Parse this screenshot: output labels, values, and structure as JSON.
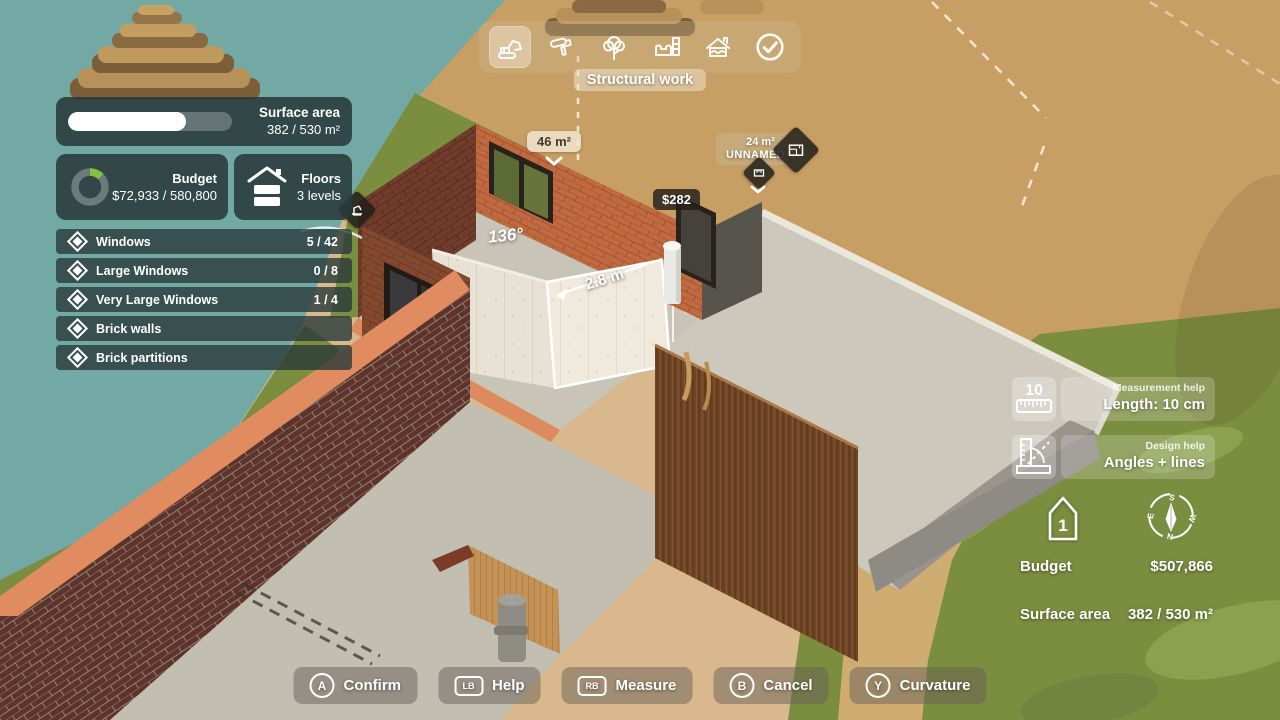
{
  "toolbar": {
    "tools": [
      {
        "icon": "excavator-icon",
        "selected": true
      },
      {
        "icon": "paint-roller-icon",
        "selected": false
      },
      {
        "icon": "tree-icon",
        "selected": false
      },
      {
        "icon": "furniture-icon",
        "selected": false
      },
      {
        "icon": "roof-icon",
        "selected": false
      },
      {
        "icon": "check-circle-icon",
        "selected": false
      }
    ],
    "active_tool_label": "Structural work"
  },
  "surface_panel": {
    "title": "Surface area",
    "value": "382 / 530 m²",
    "progress_pct": 72.1,
    "fill_style": "width:72.1%"
  },
  "budget_panel": {
    "title": "Budget",
    "value": "$72,933 / 580,800",
    "progress_pct": 12.6,
    "donut_dash": "11.9 82.4",
    "donut_color": "#84c341"
  },
  "floors_panel": {
    "title": "Floors",
    "value": "3 levels"
  },
  "materials": [
    {
      "label": "Windows",
      "count": "5 / 42"
    },
    {
      "label": "Large Windows",
      "count": "0 / 8"
    },
    {
      "label": "Very Large Windows",
      "count": "1 / 4"
    },
    {
      "label": "Brick walls",
      "count": ""
    },
    {
      "label": "Brick partitions",
      "count": ""
    }
  ],
  "scene": {
    "area_label": "46 m²",
    "cost_label": "$282",
    "room_area": "24 m²",
    "room_name": "UNNAMED 4",
    "angle": "136°",
    "length": "2.8 m"
  },
  "help": [
    {
      "icon": "ruler-icon",
      "category": "Measurement help",
      "value": "Length: 10 cm"
    },
    {
      "icon": "angle-tool-icon",
      "category": "Design help",
      "value": "Angles + lines"
    }
  ],
  "status": {
    "level": "1",
    "compass": {
      "n": "N",
      "s": "S",
      "e": "E",
      "w": "W"
    },
    "rows": [
      {
        "label": "Budget",
        "value": "$507,866"
      },
      {
        "label": "Surface area",
        "value": "382 / 530 m²"
      }
    ]
  },
  "actions": [
    {
      "key": "A",
      "shape": "circle",
      "label": "Confirm"
    },
    {
      "key": "LB",
      "shape": "rect",
      "label": "Help"
    },
    {
      "key": "RB",
      "shape": "rect",
      "label": "Measure"
    },
    {
      "key": "B",
      "shape": "circle",
      "label": "Cancel"
    },
    {
      "key": "Y",
      "shape": "circle",
      "label": "Curvature"
    }
  ],
  "colors": {
    "water": "#73a9a4",
    "grass": "#7b8d3f",
    "dirt": "#c79e63",
    "sand": "#d8b88c",
    "brick_orange": "#c06a41",
    "brick_dark": "#5f332a",
    "accent_green": "#84c341",
    "panel_bg": "#29393b"
  }
}
